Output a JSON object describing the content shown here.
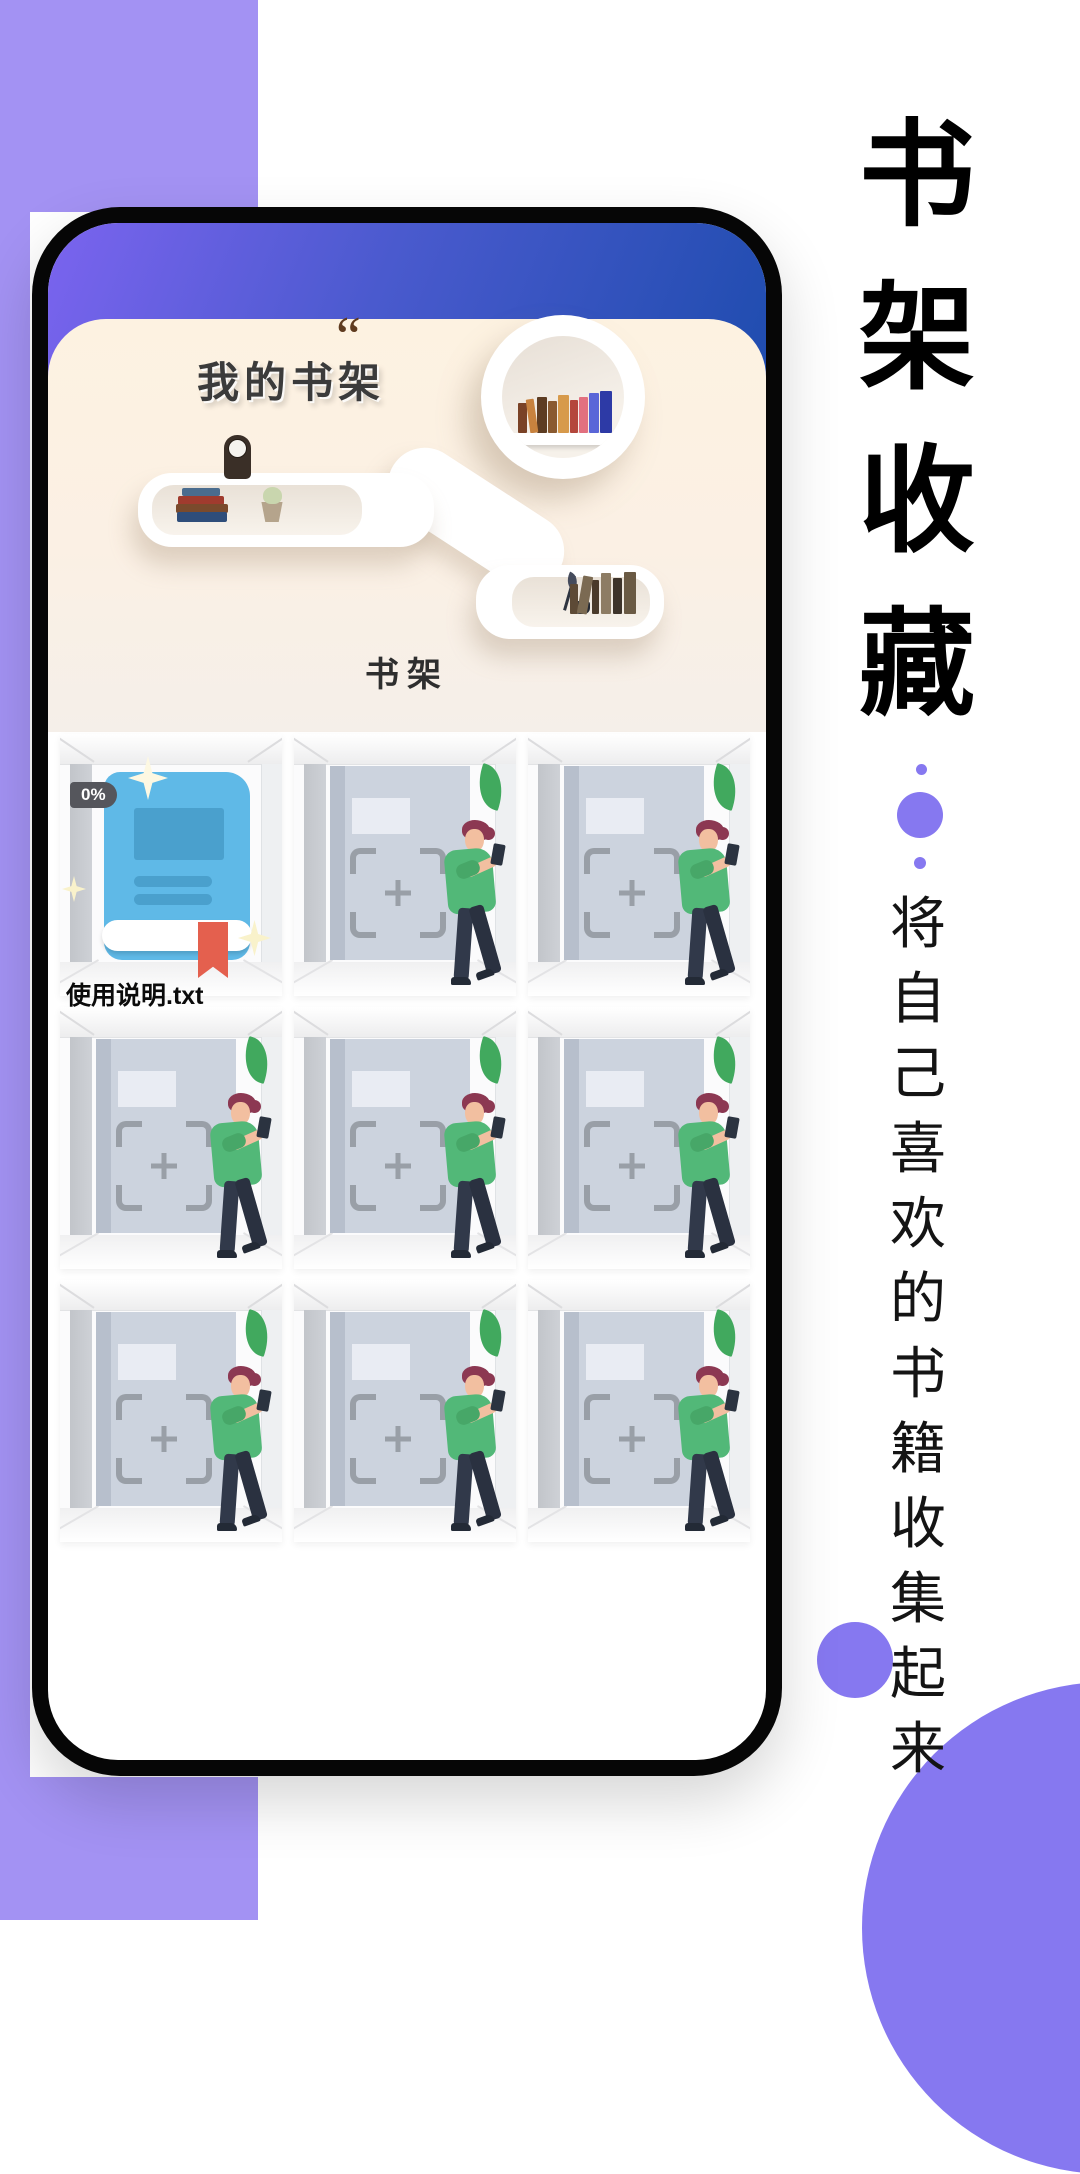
{
  "app": {
    "screen_title": "我的书架",
    "decor_quote": "“",
    "shelf_section_label": "书架",
    "book_item": {
      "progress_badge": "0%",
      "filename": "使用说明.txt"
    },
    "empty_slot_count": 8
  },
  "marketing": {
    "headline_chars": [
      "书",
      "架",
      "收",
      "藏"
    ],
    "tagline_chars": [
      "将",
      "自",
      "己",
      "喜",
      "欢",
      "的",
      "书",
      "籍",
      "收",
      "集",
      "起",
      "来"
    ]
  },
  "colors": {
    "left_shape_purple": "#a392f3",
    "right_shape_purple": "#8678f0",
    "header_gradient_start": "#7b64ef",
    "header_gradient_end": "#1e4cae",
    "panel_cream": "#fbf1e3",
    "book_cover_blue": "#5fb9e7",
    "bookmark_red": "#e4604e",
    "leaf_green": "#41a95e",
    "shirt_green": "#52b878"
  }
}
